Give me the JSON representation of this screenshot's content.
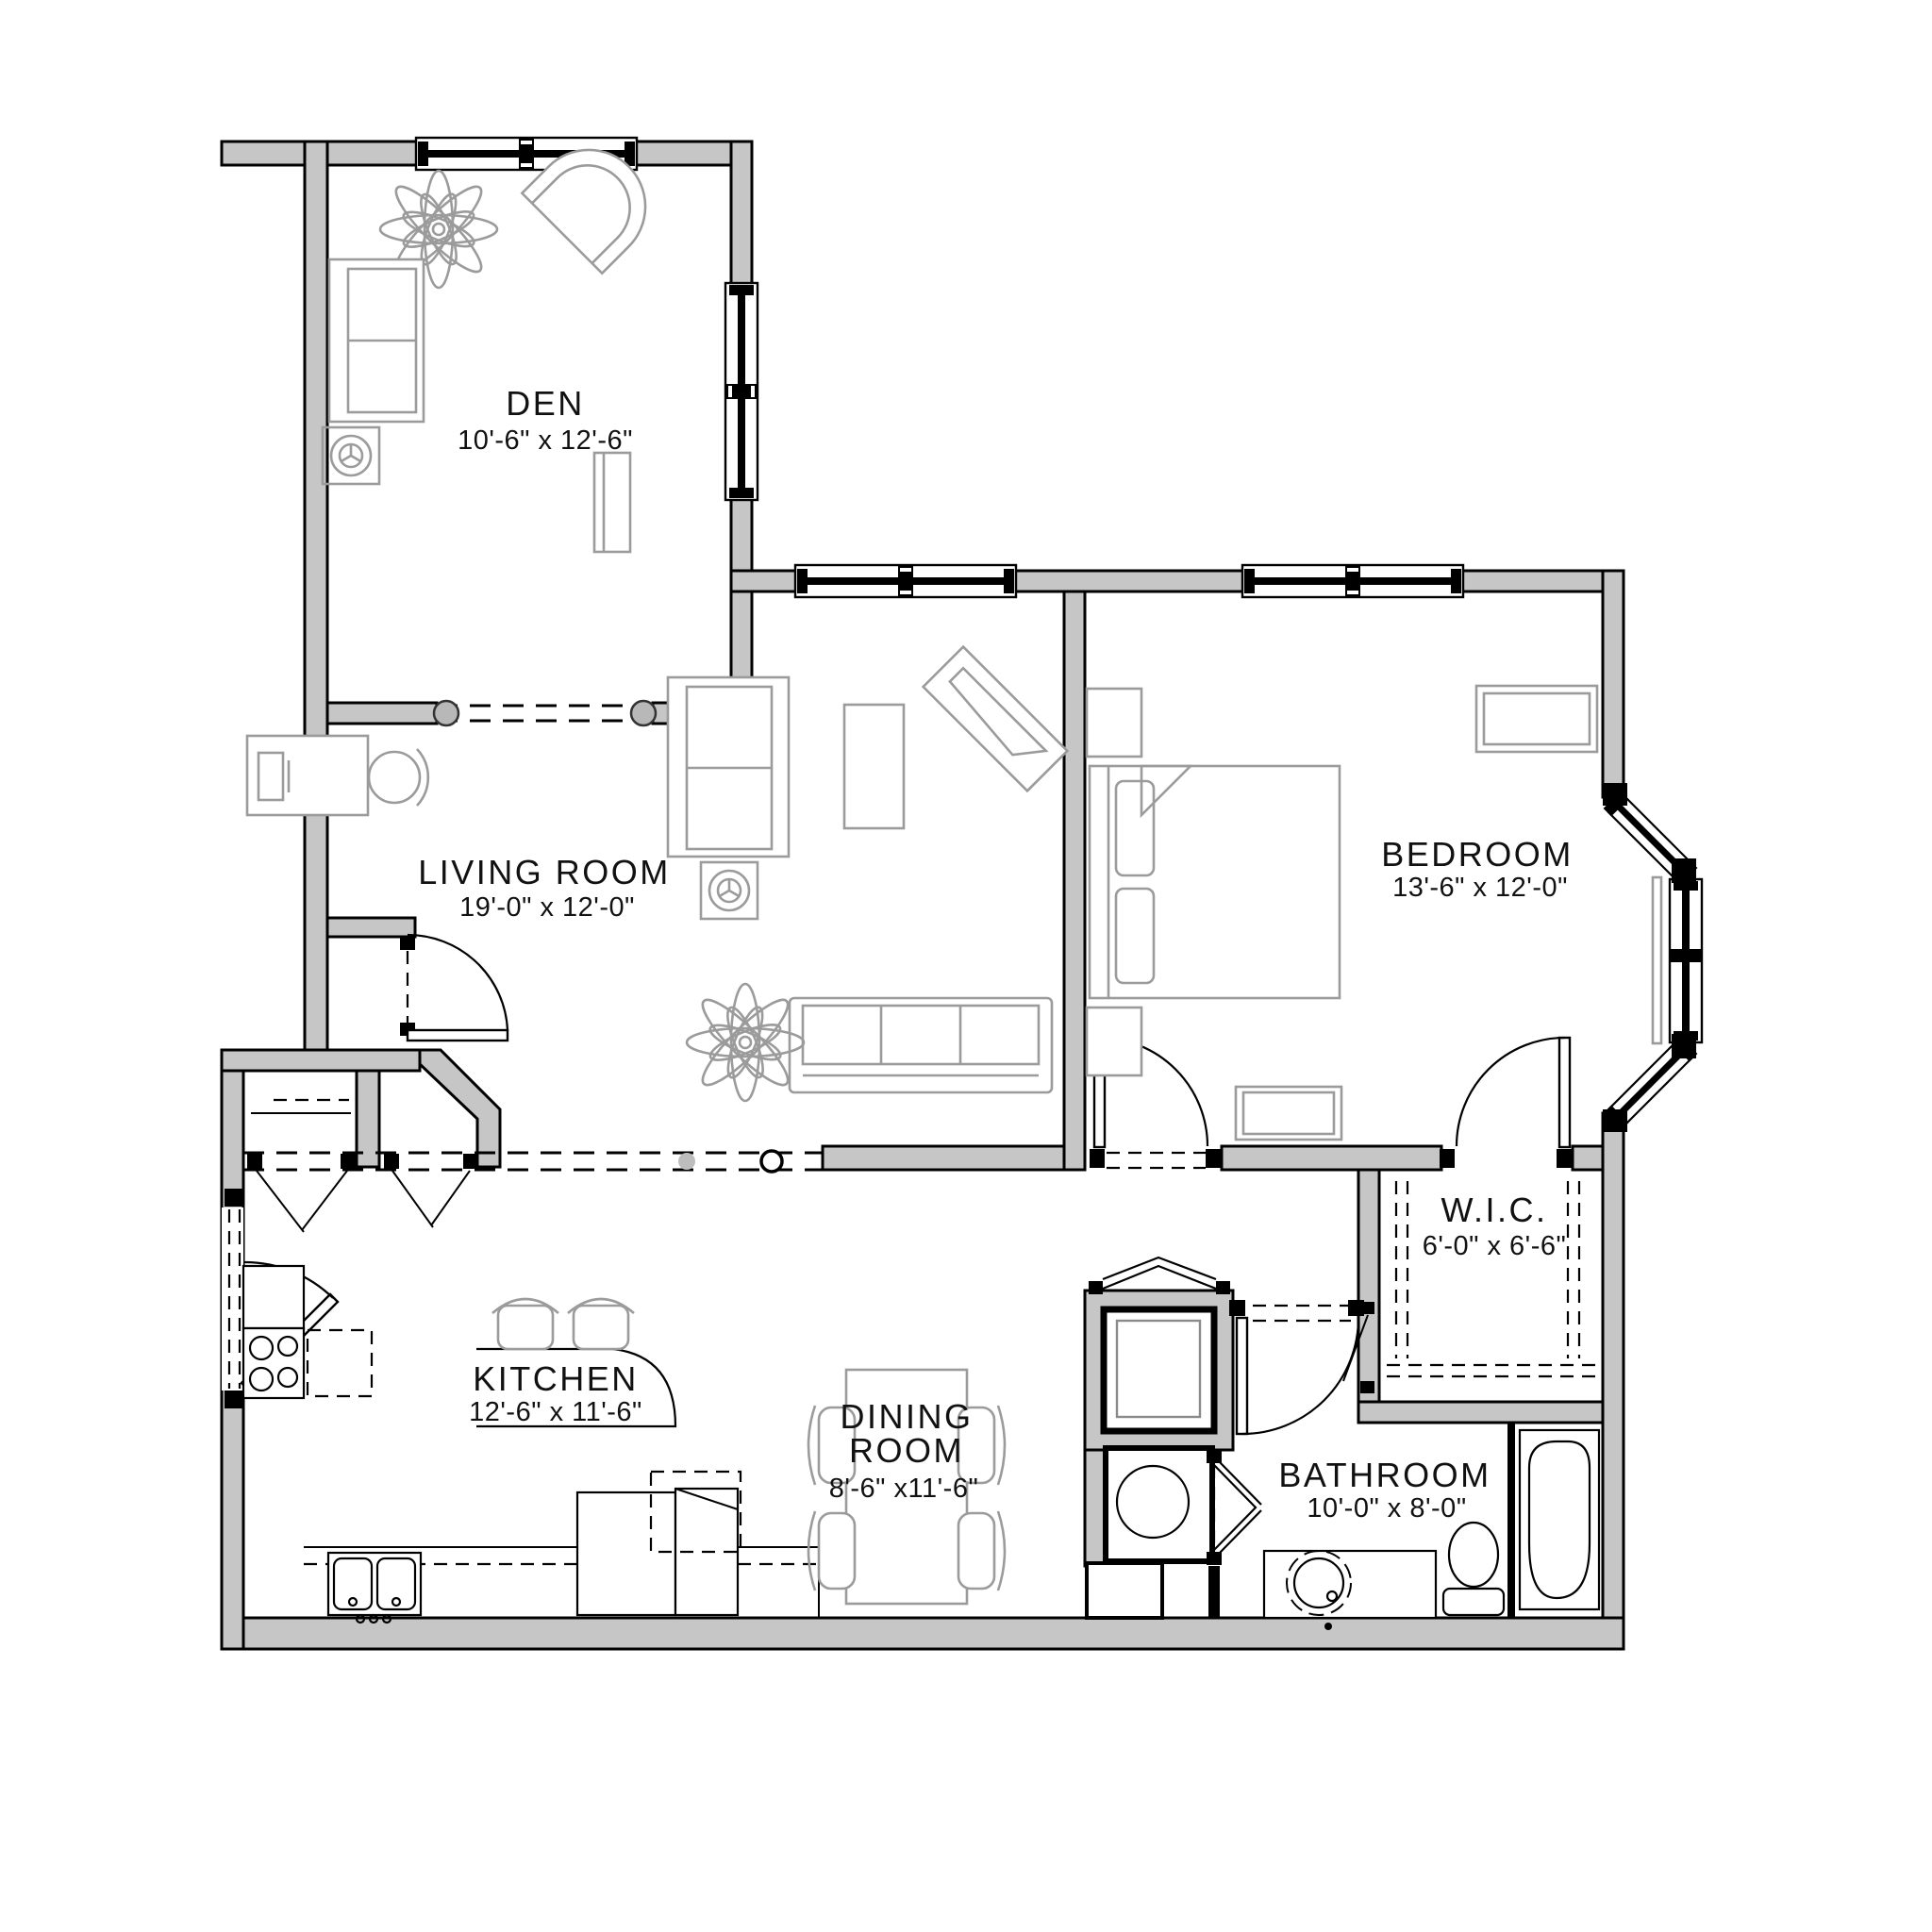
{
  "plan_title": "One-bedroom with den apartment floor plan",
  "colors": {
    "wall_fill": "#c6c6c6",
    "wall_line": "#000000",
    "furniture_line": "#9b9b9b",
    "background": "#ffffff",
    "text": "#111111"
  },
  "rooms": {
    "den": {
      "name": "DEN",
      "dims": "10'-6\" x 12'-6\""
    },
    "living": {
      "name": "LIVING ROOM",
      "dims": "19'-0\" x 12'-0\""
    },
    "bedroom": {
      "name": "BEDROOM",
      "dims": "13'-6\" x 12'-0\""
    },
    "wic": {
      "name": "W.I.C.",
      "dims": "6'-0\" x 6'-6\""
    },
    "kitchen": {
      "name": "KITCHEN",
      "dims": "12'-6\" x 11'-6\""
    },
    "dining": {
      "name_line1": "DINING",
      "name_line2": "ROOM",
      "dims": "8'-6\" x11'-6\""
    },
    "bathroom": {
      "name": "BATHROOM",
      "dims": "10'-0\" x 8'-0\""
    }
  }
}
